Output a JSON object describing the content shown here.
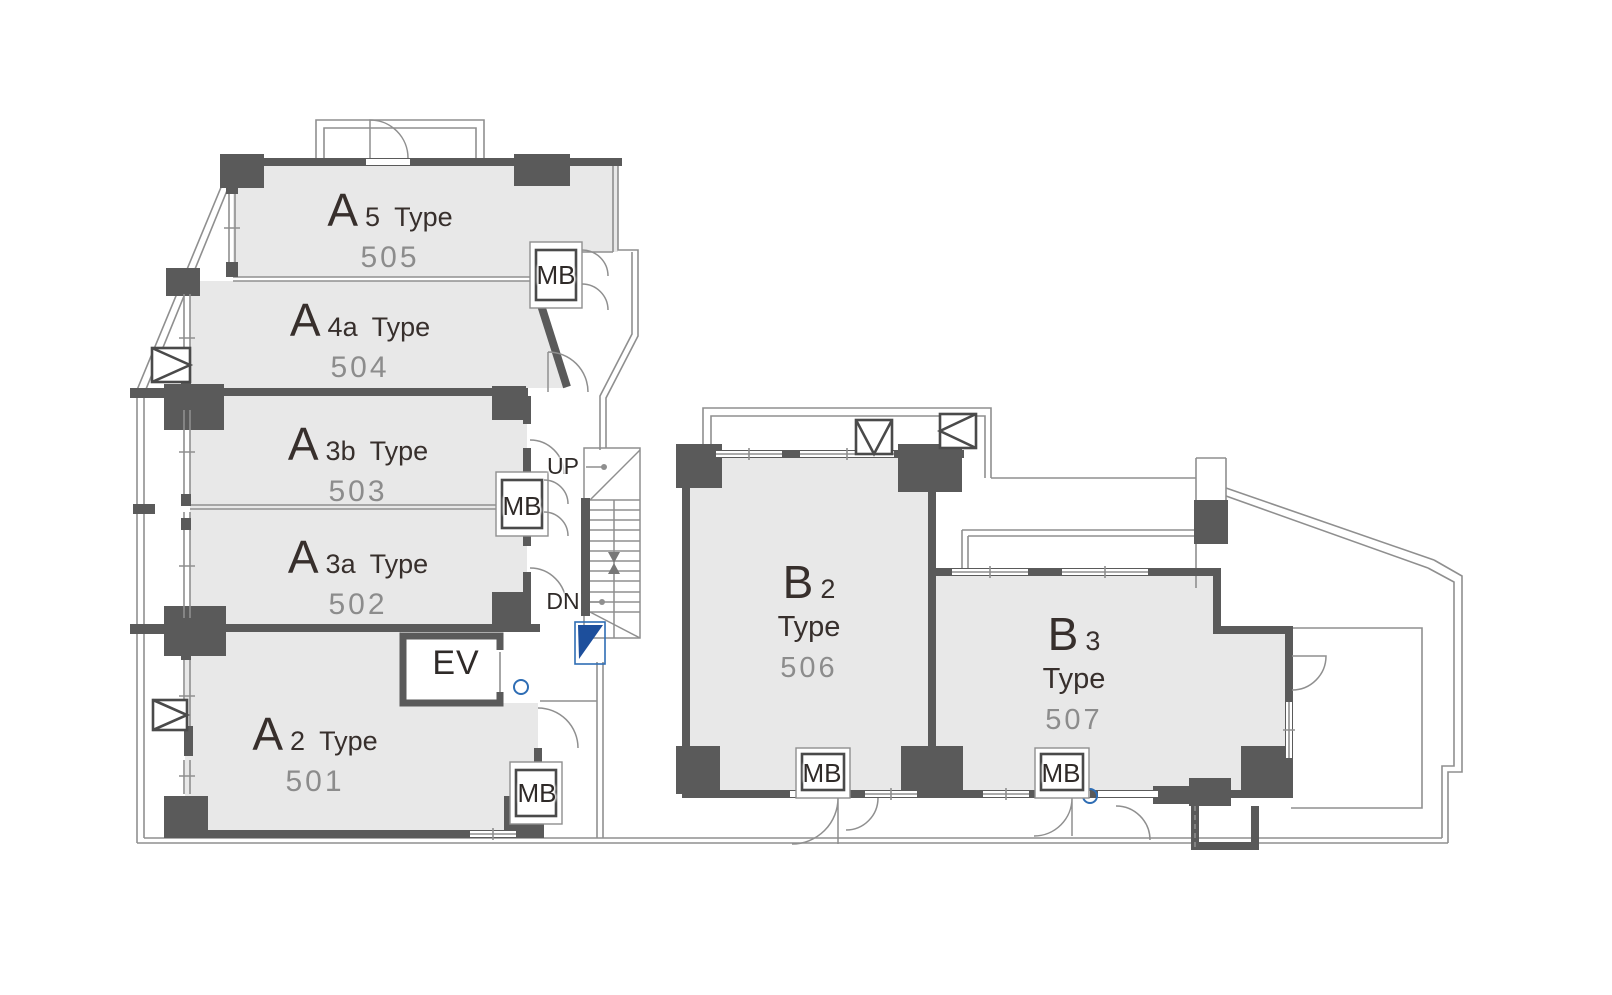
{
  "units": [
    {
      "letter": "A",
      "variant": "5",
      "type_word": "Type",
      "number": "505"
    },
    {
      "letter": "A",
      "variant": "4a",
      "type_word": "Type",
      "number": "504"
    },
    {
      "letter": "A",
      "variant": "3b",
      "type_word": "Type",
      "number": "503"
    },
    {
      "letter": "A",
      "variant": "3a",
      "type_word": "Type",
      "number": "502"
    },
    {
      "letter": "A",
      "variant": "2",
      "type_word": "Type",
      "number": "501"
    },
    {
      "letter": "B",
      "variant": "2",
      "type_word": "Type",
      "number": "506"
    },
    {
      "letter": "B",
      "variant": "3",
      "type_word": "Type",
      "number": "507"
    }
  ],
  "labels": {
    "elevator": "EV",
    "mailbox": "MB",
    "stairs_up": "UP",
    "stairs_down": "DN"
  },
  "colors": {
    "unit_fill": "#e8e8e8",
    "wall": "#5a5a5a",
    "thin_line": "#8f8f8f",
    "label_text": "#372f2c",
    "number_text": "#8c8c8c",
    "accent_blue": "#1d4f9c",
    "accent_blue_light": "#2e6db4"
  }
}
